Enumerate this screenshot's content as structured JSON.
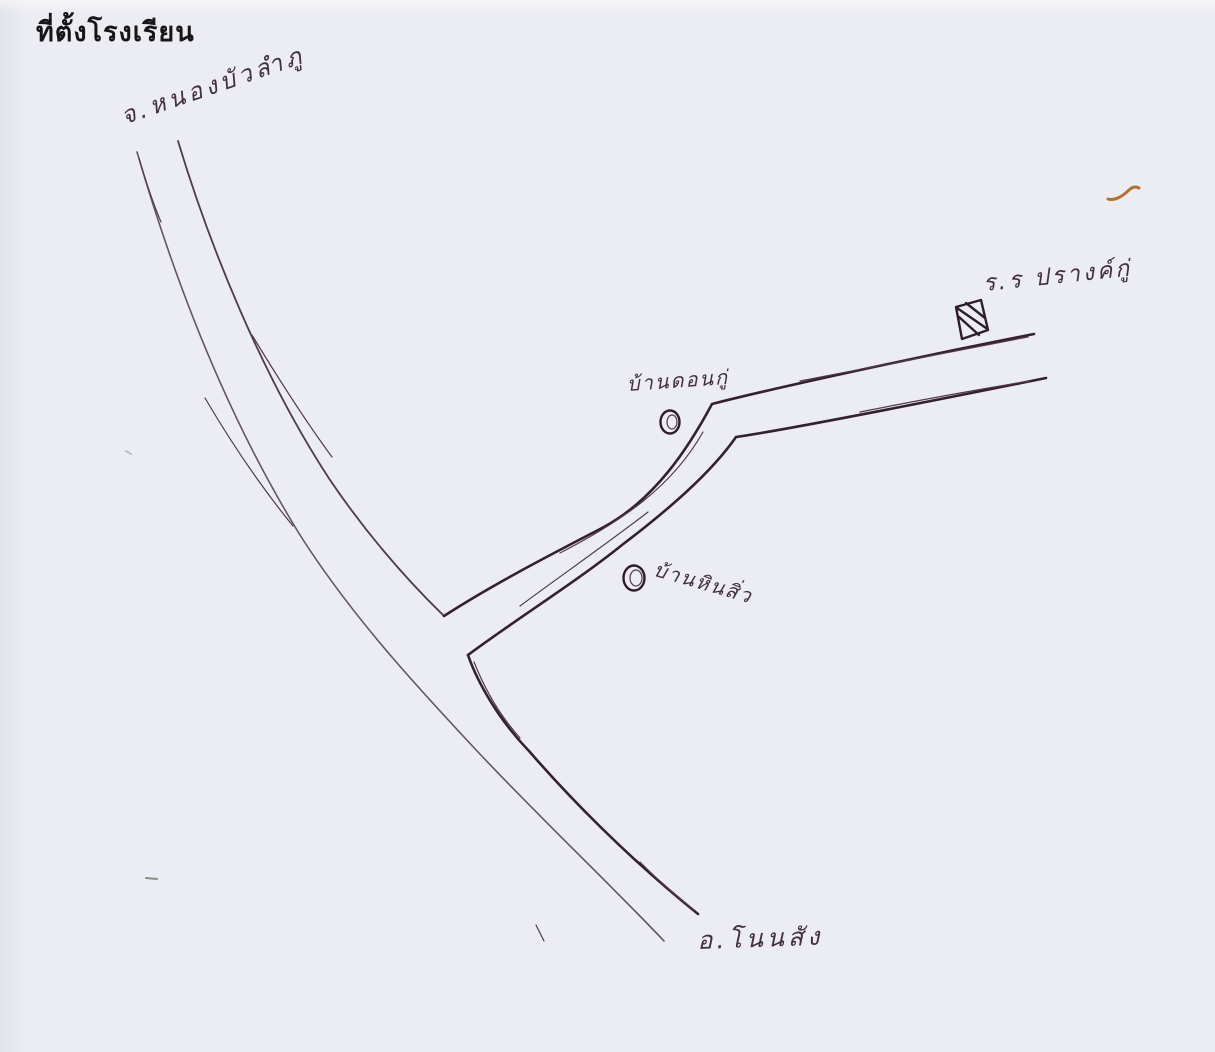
{
  "page": {
    "title": "ที่ตั้งโรงเรียน",
    "paper_color": "#ecedf3",
    "ink_color": "#43303f",
    "accent_brown": "#b0702f"
  },
  "map": {
    "type": "hand-drawn-sketch-map",
    "labels": {
      "province": "จ.หนองบัวลำภู",
      "school": "ร.ร ปรางค์กู่",
      "village_don_ku": "บ้านดอนกู่",
      "village_hin_siw": "บ้านหินสิ่ว",
      "district": "อ.โนนสัง"
    },
    "markers": [
      {
        "id": "school-marker",
        "type": "hatched-square",
        "label": "ร.ร ปรางค์กู่"
      },
      {
        "id": "don-ku-marker",
        "type": "double-circle",
        "label": "บ้านดอนกู่"
      },
      {
        "id": "hin-siw-marker",
        "type": "double-circle",
        "label": "บ้านหินสิ่ว"
      }
    ],
    "roads": [
      {
        "id": "main-road",
        "from": "จ.หนองบัวลำภู",
        "to": "อ.โนนสัง",
        "style": "double-line"
      },
      {
        "id": "school-branch-road",
        "from": "junction",
        "to": "ร.ร ปรางค์กู่",
        "style": "double-line"
      }
    ]
  }
}
